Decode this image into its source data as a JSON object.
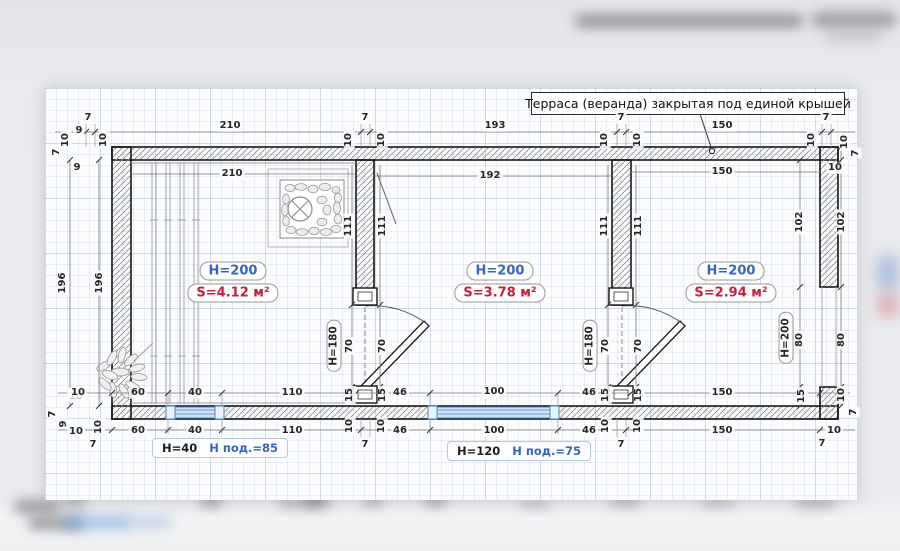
{
  "callout": {
    "text": "Терраса (веранда) закрытая под единой крышей"
  },
  "rooms": [
    {
      "height": "H=200",
      "area": "S=4.12 м²"
    },
    {
      "height": "H=200",
      "area": "S=3.78 м²"
    },
    {
      "height": "H=200",
      "area": "S=2.94 м²"
    }
  ],
  "windows": [
    {
      "height": "H=40",
      "sill": "Н под.=85"
    },
    {
      "height": "H=120",
      "sill": "Н под.=75"
    }
  ],
  "colors": {
    "height_label": "#3565c0",
    "area_label": "#c5203a",
    "sill_label": "#3565c0",
    "window_frame": "#4f86c2",
    "window_fill": "#cfe2f4",
    "wall_outline": "#161616"
  },
  "dim_labels": [
    {
      "t": "7",
      "x": 57,
      "y": 152,
      "r": 1
    },
    {
      "t": "10",
      "x": 66,
      "y": 140,
      "r": 1
    },
    {
      "t": "9",
      "x": 79,
      "y": 131
    },
    {
      "t": "7",
      "x": 88,
      "y": 118
    },
    {
      "t": "10",
      "x": 104,
      "y": 140,
      "r": 1
    },
    {
      "t": "210",
      "x": 230,
      "y": 126
    },
    {
      "t": "10",
      "x": 349,
      "y": 140,
      "r": 1
    },
    {
      "t": "7",
      "x": 365,
      "y": 118
    },
    {
      "t": "10",
      "x": 382,
      "y": 140,
      "r": 1
    },
    {
      "t": "193",
      "x": 495,
      "y": 126
    },
    {
      "t": "10",
      "x": 605,
      "y": 140,
      "r": 1
    },
    {
      "t": "7",
      "x": 621,
      "y": 118
    },
    {
      "t": "10",
      "x": 638,
      "y": 140,
      "r": 1
    },
    {
      "t": "150",
      "x": 722,
      "y": 126
    },
    {
      "t": "10",
      "x": 812,
      "y": 140,
      "r": 1
    },
    {
      "t": "7",
      "x": 826,
      "y": 118
    },
    {
      "t": "10",
      "x": 845,
      "y": 142,
      "r": 1
    },
    {
      "t": "7",
      "x": 856,
      "y": 153,
      "r": 1
    },
    {
      "t": "210",
      "x": 232,
      "y": 174
    },
    {
      "t": "192",
      "x": 490,
      "y": 176
    },
    {
      "t": "150",
      "x": 722,
      "y": 172
    },
    {
      "t": "9",
      "x": 77,
      "y": 168
    },
    {
      "t": "196",
      "x": 63,
      "y": 283,
      "r": 1
    },
    {
      "t": "196",
      "x": 100,
      "y": 283,
      "r": 1
    },
    {
      "t": "10",
      "x": 76,
      "y": 397
    },
    {
      "t": "7",
      "x": 53,
      "y": 414,
      "r": 1
    },
    {
      "t": "9",
      "x": 64,
      "y": 424,
      "r": 1
    },
    {
      "t": "10",
      "x": 76,
      "y": 432
    },
    {
      "t": "10",
      "x": 99,
      "y": 427,
      "r": 1
    },
    {
      "t": "7",
      "x": 93,
      "y": 445
    },
    {
      "t": "111",
      "x": 349,
      "y": 226,
      "r": 1
    },
    {
      "t": "111",
      "x": 383,
      "y": 226,
      "r": 1
    },
    {
      "t": "H=180",
      "x": 334,
      "y": 346,
      "r": 1,
      "b": 1
    },
    {
      "t": "70",
      "x": 350,
      "y": 346,
      "r": 1
    },
    {
      "t": "70",
      "x": 383,
      "y": 346,
      "r": 1
    },
    {
      "t": "15",
      "x": 350,
      "y": 395,
      "r": 1
    },
    {
      "t": "15",
      "x": 383,
      "y": 395,
      "r": 1
    },
    {
      "t": "111",
      "x": 605,
      "y": 226,
      "r": 1
    },
    {
      "t": "111",
      "x": 639,
      "y": 226,
      "r": 1
    },
    {
      "t": "H=180",
      "x": 590,
      "y": 346,
      "r": 1,
      "b": 1
    },
    {
      "t": "70",
      "x": 606,
      "y": 346,
      "r": 1
    },
    {
      "t": "70",
      "x": 639,
      "y": 346,
      "r": 1
    },
    {
      "t": "15",
      "x": 606,
      "y": 395,
      "r": 1
    },
    {
      "t": "15",
      "x": 639,
      "y": 395,
      "r": 1
    },
    {
      "t": "10",
      "x": 835,
      "y": 168
    },
    {
      "t": "102",
      "x": 800,
      "y": 222,
      "r": 1
    },
    {
      "t": "102",
      "x": 842,
      "y": 222,
      "r": 1
    },
    {
      "t": "80",
      "x": 800,
      "y": 340,
      "r": 1
    },
    {
      "t": "80",
      "x": 842,
      "y": 340,
      "r": 1
    },
    {
      "t": "H=200",
      "x": 786,
      "y": 338,
      "r": 1,
      "b": 1
    },
    {
      "t": "15",
      "x": 802,
      "y": 396,
      "r": 1
    },
    {
      "t": "10",
      "x": 842,
      "y": 395,
      "r": 1
    },
    {
      "t": "7",
      "x": 854,
      "y": 412,
      "r": 1
    },
    {
      "t": "10",
      "x": 834,
      "y": 431
    },
    {
      "t": "7",
      "x": 822,
      "y": 444
    },
    {
      "t": "10",
      "x": 78,
      "y": 393
    },
    {
      "t": "60",
      "x": 138,
      "y": 393
    },
    {
      "t": "40",
      "x": 195,
      "y": 393
    },
    {
      "t": "110",
      "x": 292,
      "y": 393
    },
    {
      "t": "46",
      "x": 400,
      "y": 393
    },
    {
      "t": "100",
      "x": 494,
      "y": 392
    },
    {
      "t": "46",
      "x": 589,
      "y": 393
    },
    {
      "t": "150",
      "x": 722,
      "y": 393
    },
    {
      "t": "60",
      "x": 138,
      "y": 431
    },
    {
      "t": "40",
      "x": 195,
      "y": 431
    },
    {
      "t": "110",
      "x": 292,
      "y": 431
    },
    {
      "t": "10",
      "x": 350,
      "y": 426,
      "r": 1
    },
    {
      "t": "7",
      "x": 365,
      "y": 445
    },
    {
      "t": "10",
      "x": 382,
      "y": 426,
      "r": 1
    },
    {
      "t": "46",
      "x": 400,
      "y": 431
    },
    {
      "t": "100",
      "x": 494,
      "y": 431
    },
    {
      "t": "46",
      "x": 589,
      "y": 431
    },
    {
      "t": "10",
      "x": 606,
      "y": 426,
      "r": 1
    },
    {
      "t": "7",
      "x": 621,
      "y": 445
    },
    {
      "t": "10",
      "x": 638,
      "y": 426,
      "r": 1
    },
    {
      "t": "150",
      "x": 722,
      "y": 431
    }
  ]
}
